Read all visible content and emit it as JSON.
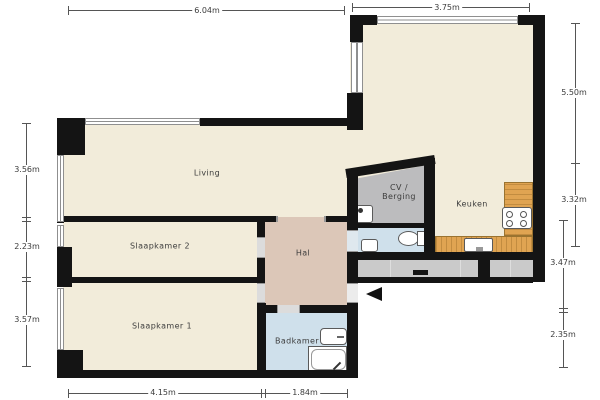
{
  "rooms": {
    "living": "Living",
    "slaapkamer2": "Slaapkamer 2",
    "slaapkamer1": "Slaapkamer 1",
    "hal": "Hal",
    "badkamer": "Badkamer",
    "keuken": "Keuken",
    "cv_line1": "CV /",
    "cv_line2": "Berging"
  },
  "dimensions": {
    "top_left": "6.04m",
    "top_right": "3.75m",
    "left_top": "3.56m",
    "left_middle": "2.23m",
    "left_bottom": "3.57m",
    "right_top": "5.50m",
    "right_middle": "3.32m",
    "right_lower": "3.47m",
    "right_bottom": "2.35m",
    "bottom_left": "4.15m",
    "bottom_right": "1.84m"
  },
  "colors": {
    "wall": "#141414",
    "floor_cream": "#f2ecda",
    "floor_hal": "#dcc7b8",
    "floor_bath": "#cfe0eb",
    "floor_storage": "#bcbcbe",
    "floor_gallery": "#cacaca",
    "counter_wood": "#e0a452"
  }
}
